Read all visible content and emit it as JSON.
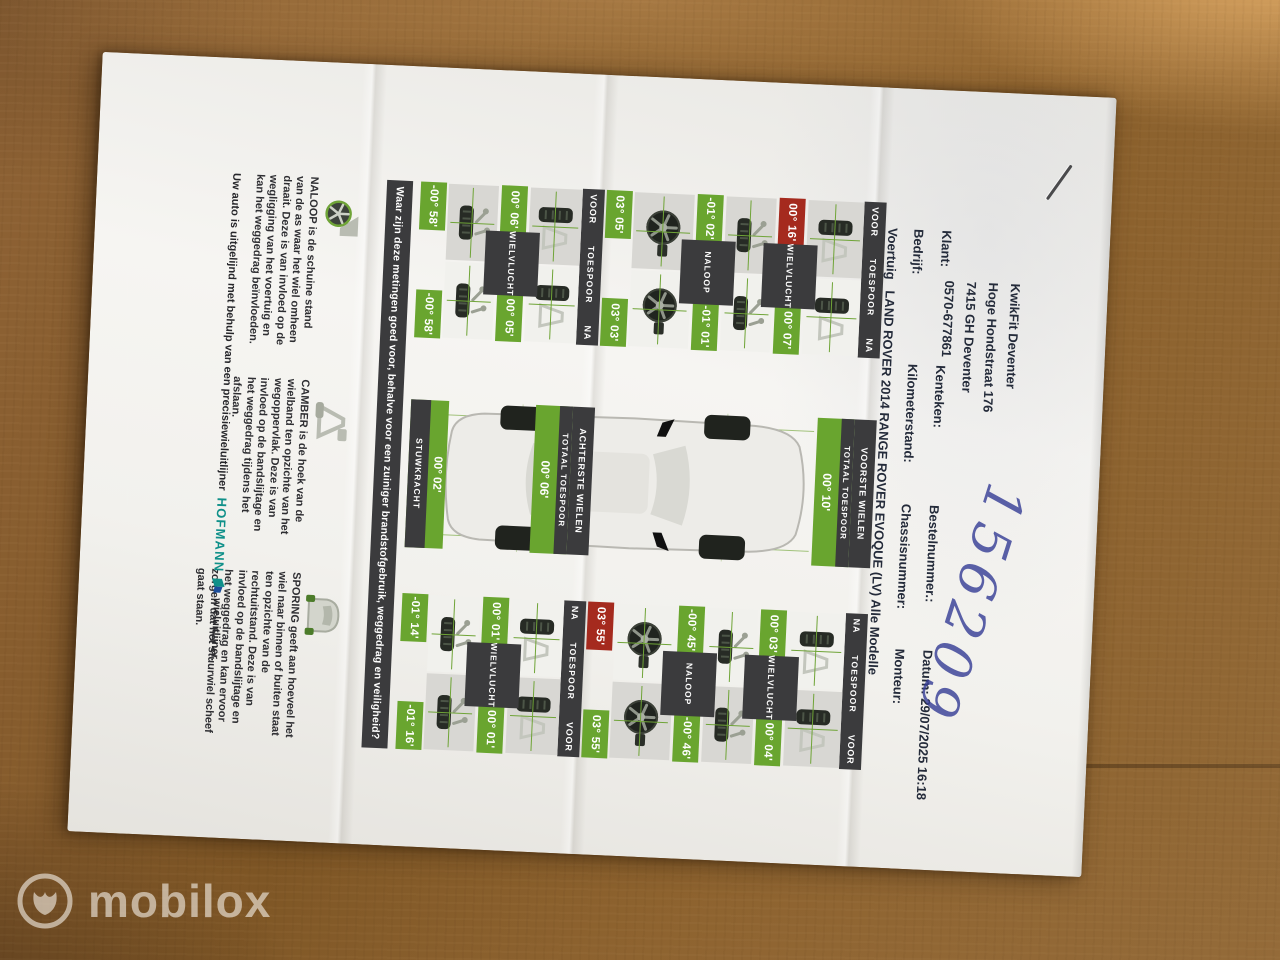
{
  "header": {
    "address_lines": [
      "KwikFit Deventer",
      "Hoge Hondstraat 176",
      "7415 GH Deventer",
      "0570-677861"
    ],
    "klant_label": "Klant:",
    "bedrijf_label": "Bedrijf:",
    "kenteken_label": "Kenteken:",
    "kilometerstand_label": "Kilometerstand:",
    "bestelnummer_label": "Bestelnummer.:",
    "chassisnummer_label": "Chassisnummer:",
    "datum_label": "Datum:",
    "datum_value": "29/07/2025 16:18",
    "monteur_label": "Monteur:",
    "voertuig_label": "Voertuig",
    "voertuig_value": "LAND ROVER 2014 RANGE ROVER EVOQUE (LV) Alle Modelle",
    "handwritten_number": "156209"
  },
  "alignment": {
    "labels": {
      "voor": "VOOR",
      "na": "NA",
      "toespoor": "TOESPOOR",
      "wielvlucht": "WIELVLUCHT",
      "naloop": "NALOOP",
      "totaal": "TOTAAL TOESPOOR"
    },
    "front": {
      "title": "VOORSTE WIELEN",
      "total_value": "00° 10'",
      "left": {
        "toespoor": {
          "voor": {
            "value": "00° 16'",
            "status": "red"
          },
          "na": {
            "value": "00° 07'",
            "status": "green"
          }
        },
        "wielvlucht": {
          "voor": {
            "value": "-01° 02'",
            "status": "green"
          },
          "na": {
            "value": "-01° 01'",
            "status": "green"
          }
        },
        "naloop": {
          "voor": {
            "value": "03° 05'",
            "status": "green"
          },
          "na": {
            "value": "03° 03'",
            "status": "green"
          }
        }
      },
      "right": {
        "toespoor": {
          "na": {
            "value": "00° 03'",
            "status": "green"
          },
          "voor": {
            "value": "00° 04'",
            "status": "green"
          }
        },
        "wielvlucht": {
          "na": {
            "value": "-00° 45'",
            "status": "green"
          },
          "voor": {
            "value": "-00° 46'",
            "status": "green"
          }
        },
        "naloop": {
          "na": {
            "value": "03° 55'",
            "status": "red"
          },
          "voor": {
            "value": "03° 55'",
            "status": "green"
          }
        }
      }
    },
    "rear": {
      "title": "ACHTERSTE WIELEN",
      "total_value": "00° 06'",
      "left": {
        "toespoor": {
          "voor": {
            "value": "00° 06'",
            "status": "green"
          },
          "na": {
            "value": "00° 05'",
            "status": "green"
          }
        },
        "wielvlucht": {
          "voor": {
            "value": "-00° 58'",
            "status": "green"
          },
          "na": {
            "value": "-00° 58'",
            "status": "green"
          }
        }
      },
      "right": {
        "toespoor": {
          "na": {
            "value": "00° 01'",
            "status": "green"
          },
          "voor": {
            "value": "00° 01'",
            "status": "green"
          }
        },
        "wielvlucht": {
          "na": {
            "value": "-01° 14'",
            "status": "green"
          },
          "voor": {
            "value": "-01° 16'",
            "status": "green"
          }
        }
      }
    },
    "stuwkracht": {
      "label": "STUWKRACHT",
      "value": "00° 02'"
    },
    "question_band": "Waar zijn deze metingen goed voor, behalve voor een zuiniger brandstofgebruik, weggedrag en veiligheid?"
  },
  "explanations": [
    {
      "text": "NALOOP is de schuine stand van de as waar het wiel omheen draait. Deze is van invloed op de wegligging van het voertuig en kan het weggedrag beïnvloeden."
    },
    {
      "text": "CAMBER is de hoek van de wielband ten opzichte van het wegoppervlak. Deze is van invloed op de bandslijtage en het weggedrag tijdens het afslaan."
    },
    {
      "text": "SPORING geeft aan hoeveel het wiel naar binnen of buiten staat ten opzichte van de rechtuitstand. Deze is van invloed op de bandslijtage en het weggedrag en kan ervoor zorgen dat het stuurwiel scheef gaat staan."
    }
  ],
  "footer": {
    "prefix": "Uw auto is uitgelijnd met behulp van een precisiewieluitlijner",
    "brand": "HOFMANN",
    "suffix": "wieluitlijner."
  },
  "watermark": {
    "brand": "mobilox"
  },
  "colors": {
    "green": "#69a52f",
    "red": "#a52a1e",
    "band_dark": "#3b3b3d",
    "hofmann_teal": "#0f9089",
    "handwriting_blue": "#373e96"
  }
}
